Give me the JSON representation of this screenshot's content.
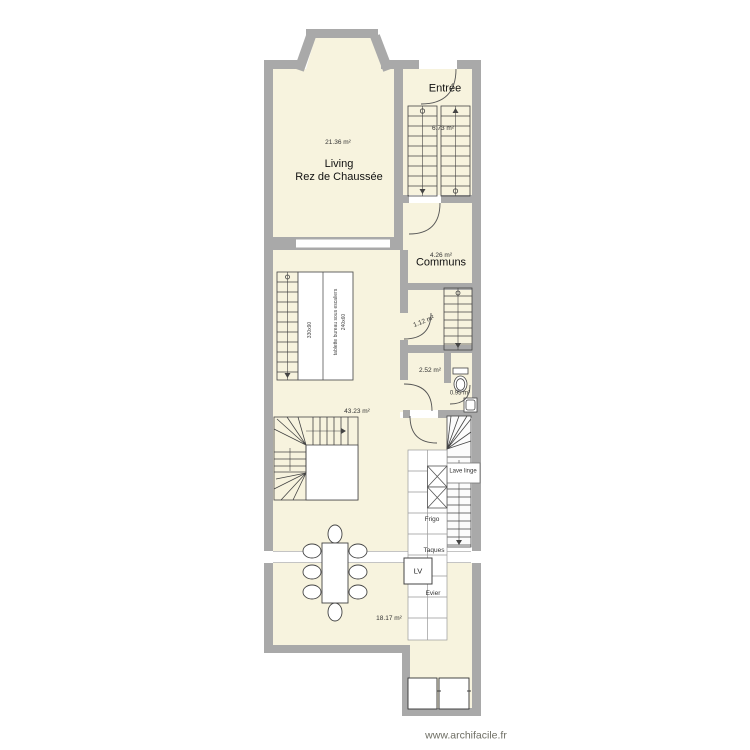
{
  "plan": {
    "watermark": "www.archifacile.fr",
    "rooms": {
      "living": {
        "name_line1": "Living",
        "name_line2": "Rez de Chaussée",
        "area": "21.36 m²"
      },
      "entree": {
        "name": "Entrée",
        "area": "6.73 m²"
      },
      "communs": {
        "name": "Communs",
        "area": "4.26 m²"
      },
      "reduit": {
        "area": "1.12 m²"
      },
      "vestibule": {
        "area": "2.52 m²"
      },
      "wc": {
        "area": "0.95 m²"
      },
      "sejour": {
        "area": "43.23 m²"
      },
      "cuisine": {
        "area": "18.17 m²"
      }
    },
    "kitchen": {
      "lave_linge": "Lave linge",
      "frigo": "Frigo",
      "taques": "Taques",
      "lv": "LV",
      "evier": "Evier"
    },
    "desk": {
      "dim_left": "330x90",
      "label": "tablette bureau sous escaliers",
      "dim_right": "240x60"
    }
  },
  "colors": {
    "wall": "#a9a9a9",
    "floor": "#f7f3de",
    "line": "#444444",
    "opening_edge": "#b0b0b0",
    "watermark_text": "#6e6e64"
  }
}
